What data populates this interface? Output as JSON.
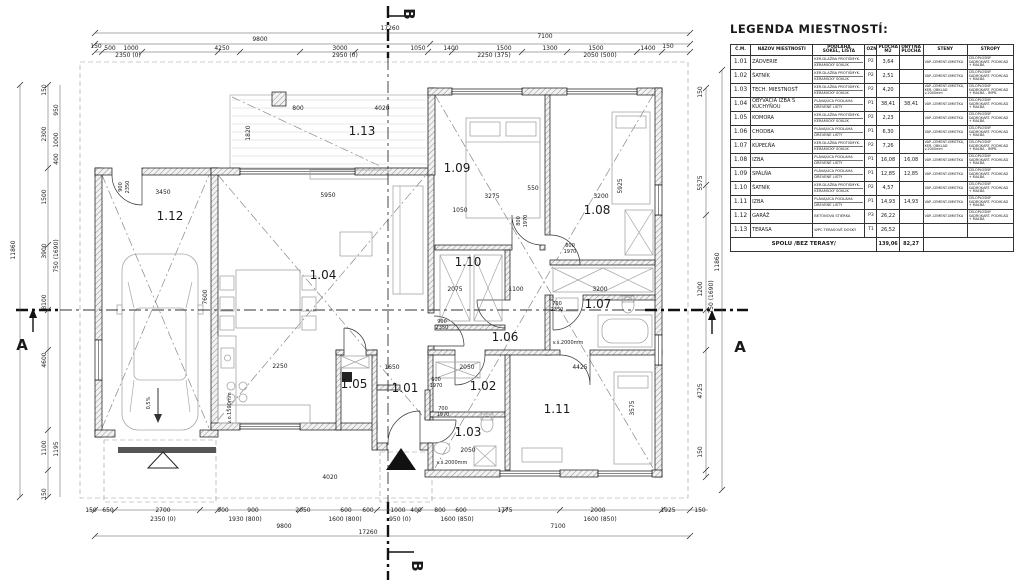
{
  "legend": {
    "title": "LEGENDA MIESTNOSTÍ:",
    "columns": [
      [
        "Č.M.",
        ""
      ],
      [
        "NÁZOV MIESTNOSTI",
        ""
      ],
      [
        "PODLAHA",
        "SOKEL, LIŠTA"
      ],
      [
        "OZN.",
        ""
      ],
      [
        "PLOCHA",
        "M2"
      ],
      [
        "OBYTNÁ",
        "PLOCHA"
      ],
      [
        "STENY",
        ""
      ],
      [
        "STROPY",
        ""
      ]
    ],
    "rows": [
      {
        "num": "1.01",
        "name": "ZÁDVERIE",
        "floor": "KER.DLAŽBA PROTIŠMYK.",
        "skirt": "KERAMICKÝ SOKLÍK",
        "mark": "P2",
        "area": "3,64",
        "living": "",
        "walls": "VÁP.-CEMENT.OMIETKA",
        "ceiling": "CELOPLOŠNÝ SADROKART. PODHĽAD + MAĽBA"
      },
      {
        "num": "1.02",
        "name": "ŠATNÍK",
        "floor": "KER.DLAŽBA PROTIŠMYK.",
        "skirt": "KERAMICKÝ SOKLÍK",
        "mark": "P2",
        "area": "2,51",
        "living": "",
        "walls": "VÁP.-CEMENT.OMIETKA",
        "ceiling": "CELOPLOŠNÝ SADROKART. PODHĽAD + MAĽBA"
      },
      {
        "num": "1.03",
        "name": "TECH. MIESTNOSŤ",
        "floor": "KER.DLAŽBA PROTIŠMYK.",
        "skirt": "KERAMICKÝ SOKLÍK",
        "mark": "P2",
        "area": "4,20",
        "living": "",
        "walls": "VÁP.-CEMENT.OMIETKA, KER. OBKLAD v.2000mm",
        "ceiling": "CELOPLOŠNÝ SADROKART. PODHĽAD + MAĽBA - IMPR."
      },
      {
        "num": "1.04",
        "name": "OBÝVACIA IZBA S KUCHYŇOU",
        "floor": "PLÁVAJÚCA PODLAHA",
        "skirt": "DREVENÉ LIŠTY",
        "mark": "P1",
        "area": "38,41",
        "living": "38,41",
        "walls": "VÁP.-CEMENT.OMIETKA",
        "ceiling": "CELOPLOŠNÝ SADROKART. PODHĽAD + MAĽBA"
      },
      {
        "num": "1.05",
        "name": "KOMORA",
        "floor": "KER.DLAŽBA PROTIŠMYK.",
        "skirt": "KERAMICKÝ SOKLÍK",
        "mark": "P2",
        "area": "2,23",
        "living": "",
        "walls": "VÁP.-CEMENT.OMIETKA",
        "ceiling": "CELOPLOŠNÝ SADROKART. PODHĽAD + MAĽBA"
      },
      {
        "num": "1.06",
        "name": "CHODBA",
        "floor": "PLÁVAJÚCA PODLAHA",
        "skirt": "DREVENÉ LIŠTY",
        "mark": "P1",
        "area": "6,30",
        "living": "",
        "walls": "VÁP.-CEMENT.OMIETKA",
        "ceiling": "CELOPLOŠNÝ SADROKART. PODHĽAD + MAĽBA"
      },
      {
        "num": "1.07",
        "name": "KÚPEĽŇA",
        "floor": "KER.DLAŽBA PROTIŠMYK.",
        "skirt": "KERAMICKÝ SOKLÍK",
        "mark": "P2",
        "area": "7,26",
        "living": "",
        "walls": "VÁP.-CEMENT.OMIETKA, KER. OBKLAD v.2000mm",
        "ceiling": "CELOPLOŠNÝ SADROKART. PODHĽAD + MAĽBA - IMPR."
      },
      {
        "num": "1.08",
        "name": "IZBA",
        "floor": "PLÁVAJÚCA PODLAHA",
        "skirt": "DREVENÉ LIŠTY",
        "mark": "P1",
        "area": "16,08",
        "living": "16,08",
        "walls": "VÁP.-CEMENT.OMIETKA",
        "ceiling": "CELOPLOŠNÝ SADROKART. PODHĽAD + MAĽBA"
      },
      {
        "num": "1.09",
        "name": "SPÁLŇA",
        "floor": "PLÁVAJÚCA PODLAHA",
        "skirt": "DREVENÉ LIŠTY",
        "mark": "P1",
        "area": "12,85",
        "living": "12,85",
        "walls": "VÁP.-CEMENT.OMIETKA",
        "ceiling": "CELOPLOŠNÝ SADROKART. PODHĽAD + MAĽBA"
      },
      {
        "num": "1.10",
        "name": "ŠATNÍK",
        "floor": "KER.DLAŽBA PROTIŠMYK.",
        "skirt": "KERAMICKÝ SOKLÍK",
        "mark": "P2",
        "area": "4,57",
        "living": "",
        "walls": "VÁP.-CEMENT.OMIETKA",
        "ceiling": "CELOPLOŠNÝ SADROKART. PODHĽAD + MAĽBA"
      },
      {
        "num": "1.11",
        "name": "IZBA",
        "floor": "PLÁVAJÚCA PODLAHA",
        "skirt": "DREVENÉ LIŠTY",
        "mark": "P1",
        "area": "14,93",
        "living": "14,93",
        "walls": "VÁP.-CEMENT.OMIETKA",
        "ceiling": "CELOPLOŠNÝ SADROKART. PODHĽAD + MAĽBA"
      },
      {
        "num": "1.12",
        "name": "GARÁŽ",
        "floor": "BETÓNOVÁ STIERKA",
        "skirt": "",
        "mark": "P3",
        "area": "26,22",
        "living": "",
        "walls": "VÁP.-CEMENT.OMIETKA",
        "ceiling": "CELOPLOŠNÝ SADROKART. PODHĽAD + MAĽBA"
      },
      {
        "num": "1.13",
        "name": "TERASA",
        "floor": "WPC TERASOVÉ DOSKY",
        "skirt": "",
        "mark": "T1",
        "area": "26,52",
        "living": "",
        "walls": "",
        "ceiling": ""
      }
    ],
    "total_label": "SPOLU /BEZ TERASY/",
    "total_area": "139,06",
    "total_living": "82,27"
  },
  "plan": {
    "rooms": [
      {
        "id": "1.01",
        "x": 405,
        "y": 392
      },
      {
        "id": "1.02",
        "x": 483,
        "y": 390
      },
      {
        "id": "1.03",
        "x": 468,
        "y": 436
      },
      {
        "id": "1.04",
        "x": 323,
        "y": 279
      },
      {
        "id": "1.05",
        "x": 354,
        "y": 388
      },
      {
        "id": "1.06",
        "x": 505,
        "y": 341
      },
      {
        "id": "1.07",
        "x": 598,
        "y": 308
      },
      {
        "id": "1.08",
        "x": 597,
        "y": 214
      },
      {
        "id": "1.09",
        "x": 457,
        "y": 172
      },
      {
        "id": "1.10",
        "x": 468,
        "y": 266
      },
      {
        "id": "1.11",
        "x": 557,
        "y": 413
      },
      {
        "id": "1.12",
        "x": 170,
        "y": 220
      },
      {
        "id": "1.13",
        "x": 362,
        "y": 135
      }
    ],
    "section_markers": [
      {
        "t": "A",
        "x": 22,
        "y": 350,
        "r": 0,
        "s": 15
      },
      {
        "t": "A",
        "x": 740,
        "y": 352,
        "r": 0,
        "s": 15
      },
      {
        "t": "B",
        "x": 404,
        "y": 14,
        "r": 90,
        "s": 15
      },
      {
        "t": "B",
        "x": 412,
        "y": 566,
        "r": 90,
        "s": 15
      }
    ],
    "texts": [
      [
        "17260",
        390,
        30
      ],
      [
        "9800",
        260,
        41
      ],
      [
        "7100",
        545,
        38
      ],
      [
        "150",
        96,
        48
      ],
      [
        "500",
        110,
        50
      ],
      [
        "1000",
        131,
        50
      ],
      [
        "4250",
        222,
        50
      ],
      [
        "3000",
        340,
        50
      ],
      [
        "1050",
        418,
        50
      ],
      [
        "1400",
        451,
        50
      ],
      [
        "1500",
        504,
        50
      ],
      [
        "1300",
        550,
        50
      ],
      [
        "1500",
        596,
        50
      ],
      [
        "1400",
        648,
        50
      ],
      [
        "150",
        668,
        48
      ],
      [
        "2350 (0)",
        128,
        57
      ],
      [
        "2950 (0)",
        345,
        57
      ],
      [
        "2250 (375)",
        494,
        57
      ],
      [
        "2050 (500)",
        600,
        57
      ],
      [
        "150",
        91,
        512
      ],
      [
        "650",
        108,
        512
      ],
      [
        "2700",
        163,
        512
      ],
      [
        "900",
        223,
        512
      ],
      [
        "900",
        253,
        512
      ],
      [
        "2050",
        303,
        512
      ],
      [
        "600",
        346,
        512
      ],
      [
        "600",
        368,
        512
      ],
      [
        "1000",
        398,
        512
      ],
      [
        "400",
        416,
        512
      ],
      [
        "800",
        440,
        512
      ],
      [
        "600",
        461,
        512
      ],
      [
        "1775",
        505,
        512
      ],
      [
        "2000",
        598,
        512
      ],
      [
        "1925",
        668,
        512
      ],
      [
        "150",
        700,
        512
      ],
      [
        "2350 (0)",
        163,
        521
      ],
      [
        "1930 (800)",
        245,
        521
      ],
      [
        "1600 (800)",
        345,
        521
      ],
      [
        "950 (0)",
        400,
        521
      ],
      [
        "1600 (850)",
        457,
        521
      ],
      [
        "1600 (850)",
        600,
        521
      ],
      [
        "9800",
        284,
        528
      ],
      [
        "7100",
        558,
        528
      ],
      [
        "17260",
        368,
        534
      ],
      [
        "150",
        46,
        90,
        -90
      ],
      [
        "950",
        58,
        110,
        -90
      ],
      [
        "2300",
        46,
        134,
        -90
      ],
      [
        "1000",
        58,
        140,
        -90
      ],
      [
        "400",
        58,
        159,
        -90
      ],
      [
        "1500",
        46,
        197,
        -90
      ],
      [
        "3900",
        46,
        251,
        -90
      ],
      [
        "750 (1690)",
        58,
        256,
        -90
      ],
      [
        "11860",
        15,
        250,
        -90
      ],
      [
        "8100",
        46,
        302,
        -90
      ],
      [
        "4600",
        46,
        360,
        -90
      ],
      [
        "1100",
        46,
        448,
        -90
      ],
      [
        "1195",
        58,
        449,
        -90
      ],
      [
        "150",
        46,
        494,
        -90
      ],
      [
        "150",
        702,
        92,
        -90
      ],
      [
        "5575",
        702,
        183,
        -90
      ],
      [
        "11860",
        719,
        262,
        -90
      ],
      [
        "1200",
        702,
        289,
        -90
      ],
      [
        "750 (1690)",
        713,
        297,
        -90
      ],
      [
        "4725",
        702,
        391,
        -90
      ],
      [
        "150",
        702,
        452,
        -90
      ],
      [
        "5950",
        328,
        197
      ],
      [
        "3450",
        163,
        194
      ],
      [
        "3275",
        492,
        198
      ],
      [
        "3200",
        601,
        198
      ],
      [
        "1050",
        460,
        212
      ],
      [
        "5925",
        622,
        186,
        -90
      ],
      [
        "3200",
        600,
        291
      ],
      [
        "4425",
        580,
        369
      ],
      [
        "2050",
        467,
        369
      ],
      [
        "2050",
        468,
        452
      ],
      [
        "3575",
        634,
        408,
        -90
      ],
      [
        "2250",
        280,
        368
      ],
      [
        "1650",
        392,
        369
      ],
      [
        "2075",
        455,
        291
      ],
      [
        "1100",
        516,
        291
      ],
      [
        "800",
        298,
        110
      ],
      [
        "4020",
        382,
        110
      ],
      [
        "1820",
        250,
        133,
        -90
      ],
      [
        "7600",
        207,
        297,
        -90
      ],
      [
        "4020",
        330,
        479
      ],
      [
        "550",
        533,
        190
      ],
      [
        "900",
        122,
        187,
        -90,
        5
      ],
      [
        "2350",
        129,
        187,
        -90,
        5
      ],
      [
        "900",
        442,
        323,
        0,
        5
      ],
      [
        "2350",
        442,
        329,
        0,
        5
      ],
      [
        "700",
        557,
        305,
        0,
        5
      ],
      [
        "2350",
        557,
        311,
        0,
        5
      ],
      [
        "800",
        520,
        221,
        -90,
        5
      ],
      [
        "1970",
        527,
        221,
        -90,
        5
      ],
      [
        "800",
        570,
        247,
        0,
        5
      ],
      [
        "1970",
        570,
        253,
        0,
        5
      ],
      [
        "600",
        436,
        381,
        0,
        5
      ],
      [
        "1970",
        436,
        387,
        0,
        5
      ],
      [
        "700",
        443,
        410,
        0,
        5
      ],
      [
        "1970",
        443,
        416,
        0,
        5
      ],
      [
        "v.š.2000mm",
        568,
        344,
        0,
        5
      ],
      [
        "v.š.2000mm",
        452,
        464,
        0,
        5
      ],
      [
        "v.o.1500mm",
        231,
        408,
        -90,
        5
      ],
      [
        "0,5%",
        150,
        403,
        -90,
        5
      ]
    ]
  }
}
